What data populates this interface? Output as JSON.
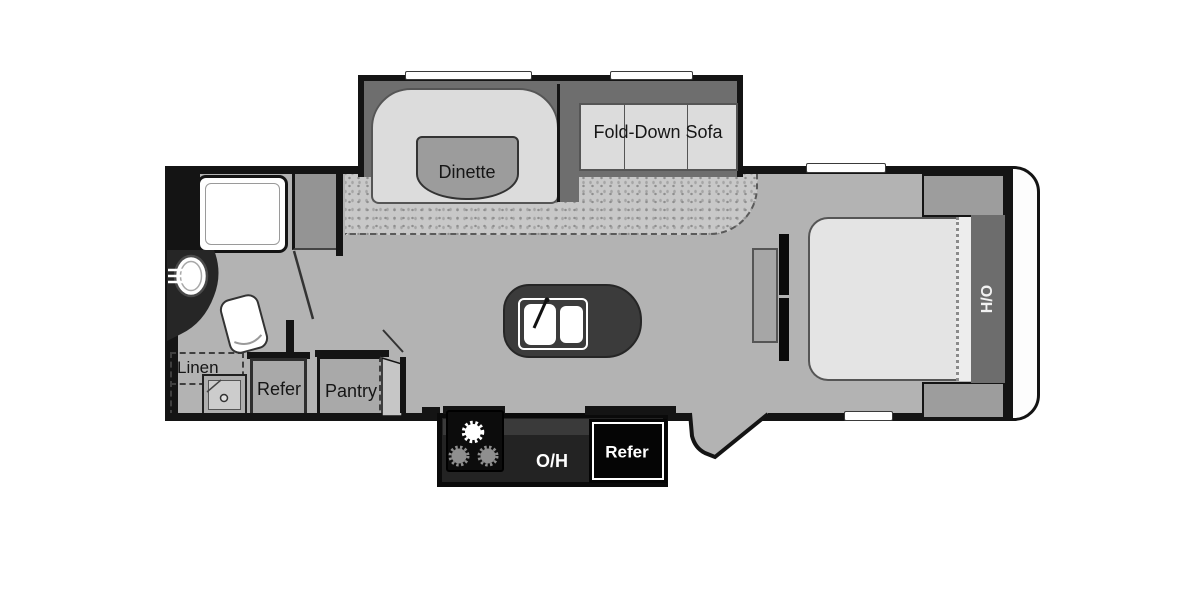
{
  "floorplan": {
    "type": "travel-trailer-floor-plan",
    "labels": {
      "dinette": "Dinette",
      "fold_down_sofa": "Fold-Down Sofa",
      "linen": "Linen",
      "refer_cabinet": "Refer",
      "pantry": "Pantry",
      "overhead_cabinet": "O/H",
      "refrigerator": "Refer",
      "head_of_bed": "H/O"
    },
    "colors": {
      "wall": "#141414",
      "floor": "#b3b3b3",
      "carpet": "#c8c8c8",
      "cushion": "#dcdcdc",
      "cabinet": "#a9a9a9",
      "island": "#3b3b3b",
      "bed": "#e4e4e4",
      "headboard": "#6d6d6d",
      "slide_interior": "#6e6e6e",
      "counter": "#232323",
      "front_cap": "#fdfdfd"
    }
  }
}
